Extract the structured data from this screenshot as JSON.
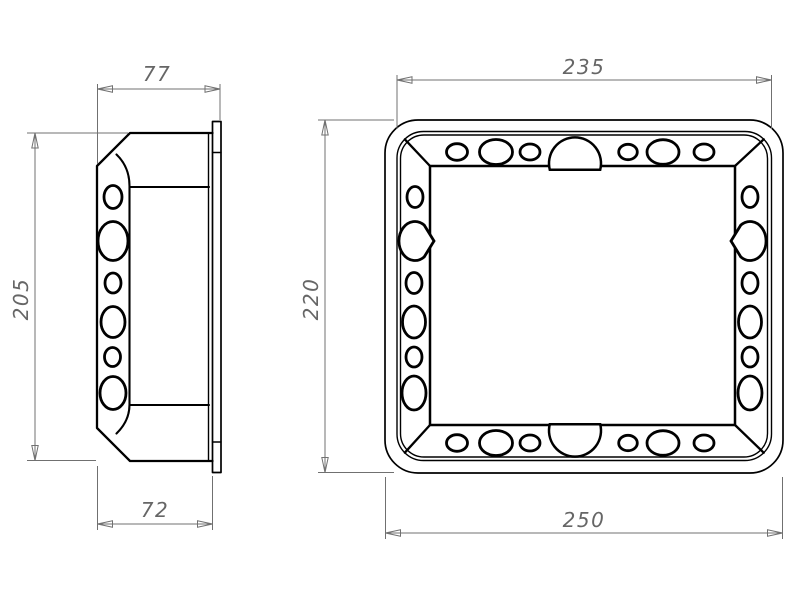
{
  "drawing": {
    "background_color": "#ffffff",
    "object_line_color": "#000000",
    "dimension_line_color": "#707070",
    "dimension_text_color": "#666666",
    "views": {
      "side_view": {
        "dimensions": {
          "depth_overall": "77",
          "height": "205",
          "depth_body": "72"
        }
      },
      "front_view": {
        "dimensions": {
          "width_inner": "235",
          "height_overall": "220",
          "width_overall": "250"
        }
      }
    }
  }
}
